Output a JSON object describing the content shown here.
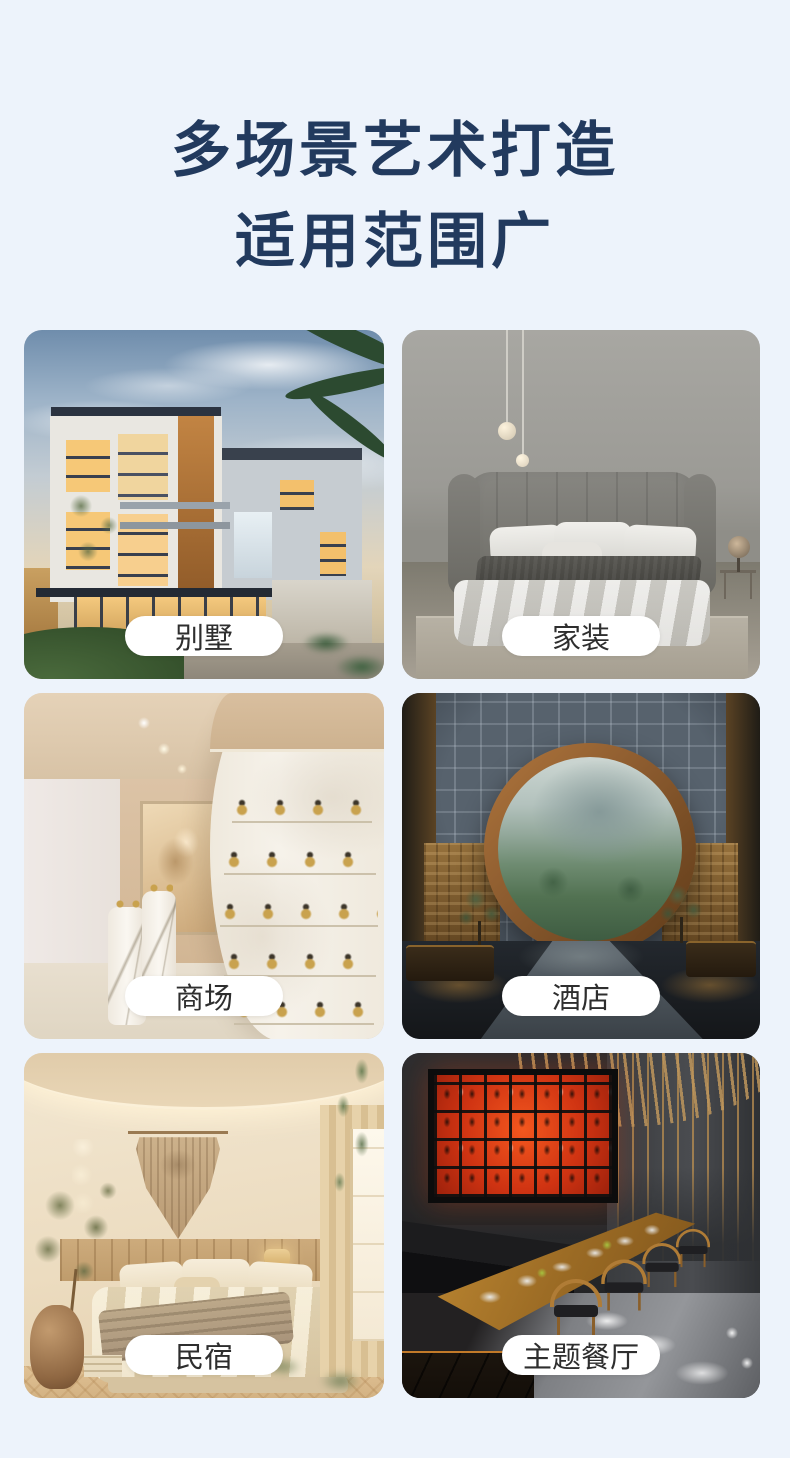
{
  "page": {
    "background_color": "#edf3fb"
  },
  "header": {
    "title_line1": "多场景艺术打造",
    "title_line2": "适用范围广",
    "title_color": "#223a5e"
  },
  "cards": [
    {
      "label": "别墅",
      "scene": "villa-exterior-dusk-photo"
    },
    {
      "label": "家装",
      "scene": "gray-bedroom-home-decor-photo"
    },
    {
      "label": "商场",
      "scene": "cream-retail-mall-interior-photo"
    },
    {
      "label": "酒店",
      "scene": "hotel-lobby-moon-gate-photo"
    },
    {
      "label": "民宿",
      "scene": "warm-homestay-bedroom-photo"
    },
    {
      "label": "主题餐厅",
      "scene": "dark-theme-restaurant-photo"
    }
  ],
  "pill": {
    "background": "#ffffff",
    "text_color": "#2e2e2e"
  }
}
